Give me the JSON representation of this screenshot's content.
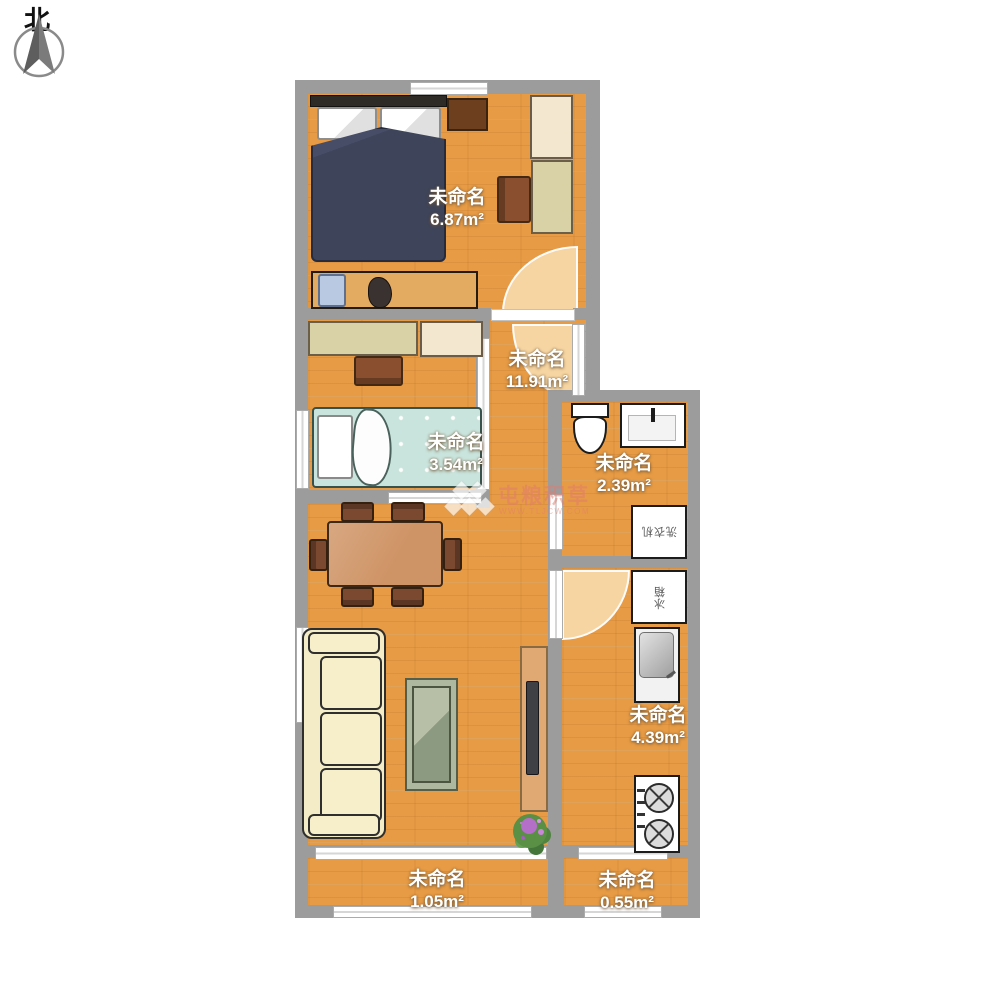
{
  "compass": {
    "label": "北"
  },
  "watermark": {
    "title": "屯粮积草",
    "url": "WWW.TLJCW.COM"
  },
  "rooms": [
    {
      "id": "bedroom-main",
      "name": "未命名",
      "area": "6.87m²"
    },
    {
      "id": "hall-living",
      "name": "未命名",
      "area": "11.91m²"
    },
    {
      "id": "bedroom-small",
      "name": "未命名",
      "area": "3.54m²"
    },
    {
      "id": "bathroom",
      "name": "未命名",
      "area": "2.39m²"
    },
    {
      "id": "kitchen",
      "name": "未命名",
      "area": "4.39m²"
    },
    {
      "id": "balcony-left",
      "name": "未命名",
      "area": "1.05m²"
    },
    {
      "id": "balcony-right",
      "name": "未命名",
      "area": "0.55m²"
    }
  ],
  "appliances": {
    "washing_machine": "洗衣机",
    "fridge": "冰箱"
  },
  "colors": {
    "wall": "#9c9c9c",
    "floor_wood": "#e79b44",
    "door_arc": "#f6d5a2",
    "bed_main": "#3e4459",
    "bed_small": "#c9e4dc",
    "sofa": "#f3ecc6",
    "dining_table": "#cf9466",
    "watermark_text": "#e27c70"
  }
}
